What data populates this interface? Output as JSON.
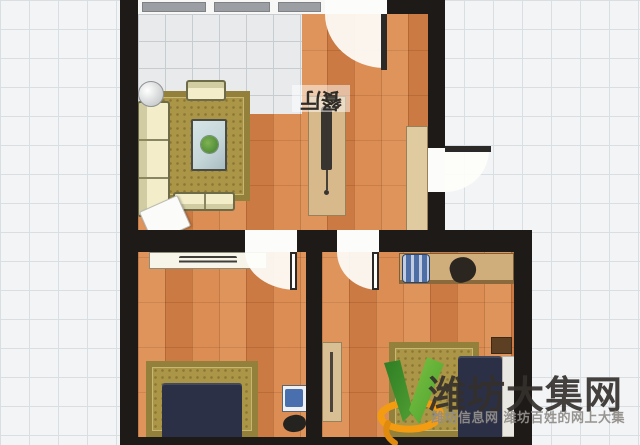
{
  "canvas": {
    "width_px": 640,
    "height_px": 445
  },
  "floorplan": {
    "dining_label": "餐厅",
    "dining_label_rotation_deg": 180,
    "doors": [
      "top-room-door",
      "entrance-door",
      "left-bedroom-door",
      "right-bedroom-door"
    ],
    "windows": [
      "top-wall-window-band"
    ],
    "furniture": [
      "sofa",
      "living-rug",
      "coffee-table",
      "plant",
      "armchair",
      "loveseat",
      "round-side-table",
      "floor-mat",
      "partition-cabinet",
      "coat-rack",
      "entry-cabinet",
      "tv-shelf",
      "bed-rug",
      "double-bed",
      "nightstand",
      "bag",
      "desk",
      "desk-chair",
      "satchel",
      "wardrobe",
      "bedroom-rug",
      "single-bed",
      "mattress-pillow"
    ]
  },
  "watermark": {
    "title": "潍坊大集网",
    "subtitle": "潍坊信息网 潍坊百姓的网上大集",
    "logo": "green-v-orange-swoosh"
  },
  "palette": {
    "wall": "#1d1a17",
    "wood": "#d8854a",
    "tile": "#e9eaec",
    "tile-line": "#c7ccd1",
    "grid-bg": "#f3f4f6",
    "grid-line": "#d9dee3",
    "rug": "#ab9546",
    "rug-border": "#93803a",
    "cream": "#f3eec9",
    "navy": "#2b3046",
    "tan": "#d6b486",
    "glass": "#c7d8da",
    "logo-green": "#56ad35",
    "logo-green-dark": "#2e7d24",
    "logo-orange": "#f39c12"
  }
}
